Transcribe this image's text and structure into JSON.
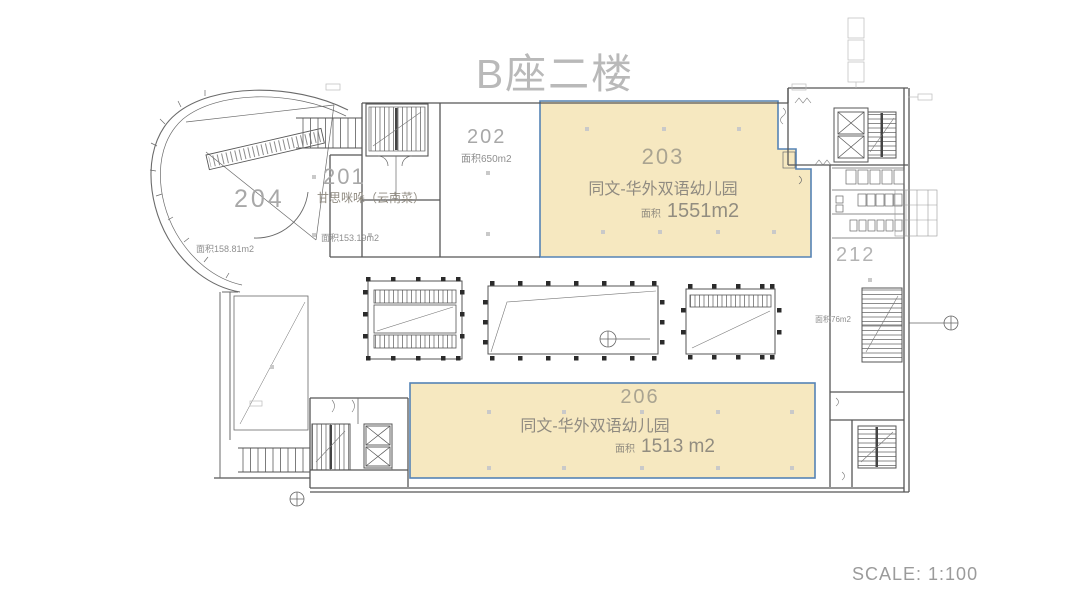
{
  "document": {
    "title": "B座二楼",
    "scale_label": "SCALE: 1:100"
  },
  "colors": {
    "highlight_fill": "#f6e8c0",
    "highlight_stroke": "#5583b5",
    "label_gray": "#9a9a9a",
    "title_gray": "#b9b9b9",
    "wall_line": "#565656"
  },
  "rooms": {
    "r201": {
      "number": "201",
      "name": "甘思咪哚（云南菜）",
      "area": "面积153.19m2"
    },
    "r202": {
      "number": "202",
      "area": "面积650m2"
    },
    "r203": {
      "number": "203",
      "name": "同文-华外双语幼儿园",
      "area_label": "面积",
      "area_value": "1551m2"
    },
    "r204": {
      "number": "204",
      "area": "面积158.81m2"
    },
    "r206": {
      "number": "206",
      "name": "同文-华外双语幼儿园",
      "area_label": "面积",
      "area_value": "1513 m2"
    },
    "r212": {
      "number": "212",
      "area": "面积76m2"
    }
  }
}
